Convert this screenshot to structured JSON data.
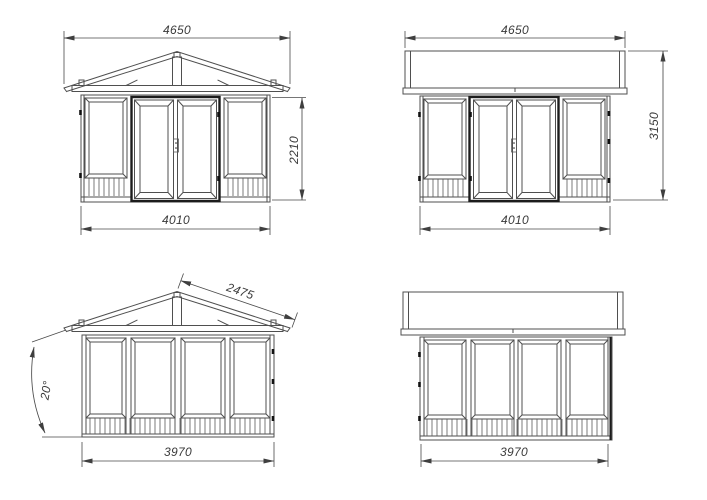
{
  "drawing": {
    "colors": {
      "background": "#ffffff",
      "line": "#4f4f4f",
      "bold_line": "#1c1c1c",
      "dimension_text": "#3a3a3a"
    },
    "views": {
      "front_elevation": {
        "roof_width_mm": "4650",
        "wall_height_mm": "2210",
        "base_width_mm": "4010"
      },
      "rear_elevation": {
        "roof_width_mm": "4650",
        "total_height_mm": "3150",
        "base_width_mm": "4010"
      },
      "gable_side_elevation": {
        "roof_slope_mm": "2475",
        "roof_angle": "20°",
        "base_width_mm": "3970"
      },
      "eave_side_elevation": {
        "base_width_mm": "3970"
      }
    }
  }
}
